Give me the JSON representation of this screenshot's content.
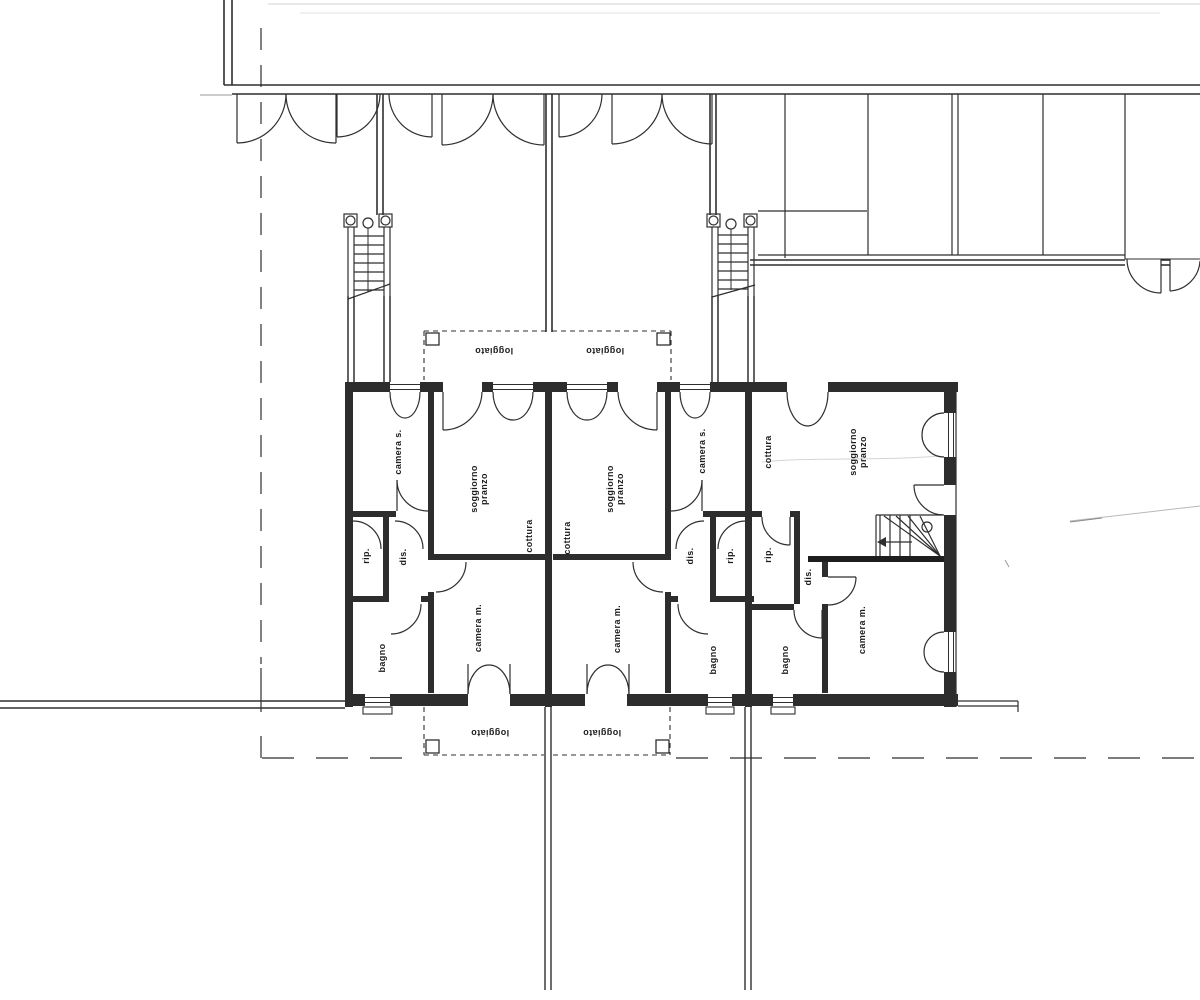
{
  "document": {
    "kind": "scanned architectural floor plan"
  },
  "palette": {
    "line": "#2f2f2f",
    "wall": "#2d2d2d",
    "paper": "#ffffff",
    "faint": "#c9c9c9"
  },
  "labels": {
    "camera_s": "camera s.",
    "soggiorno": "soggiorno",
    "pranzo": "pranzo",
    "cottura": "cottura",
    "rip": "rip.",
    "dis": "dis.",
    "bagno": "bagno",
    "camera_m": "camera m.",
    "loggiato": "loggiato"
  }
}
